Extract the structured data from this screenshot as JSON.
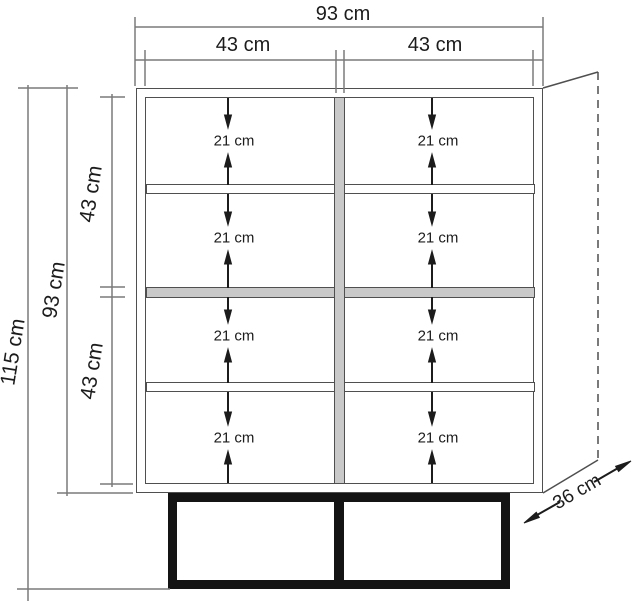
{
  "diagram": {
    "type": "furniture-dimension-drawing",
    "object": "two-door shelving cabinet with base stand"
  },
  "labels": {
    "top_width_total": "93 cm",
    "top_width_left": "43 cm",
    "top_width_right": "43 cm",
    "side_height_total": "115 cm",
    "side_height_body": "93 cm",
    "side_height_upper": "43 cm",
    "side_height_lower": "43 cm",
    "depth": "36 cm",
    "compartments": [
      "21 cm",
      "21 cm",
      "21 cm",
      "21 cm",
      "21 cm",
      "21 cm",
      "21 cm",
      "21 cm"
    ]
  },
  "colors": {
    "background": "#ffffff",
    "outline": "#4f4f4f",
    "dimension_line": "#7a7a7a",
    "arrow_black": "#1c1c1c",
    "shelf_gray_fill": "#c9c9c9",
    "base_black": "#141414",
    "text": "#1c1c1c"
  }
}
